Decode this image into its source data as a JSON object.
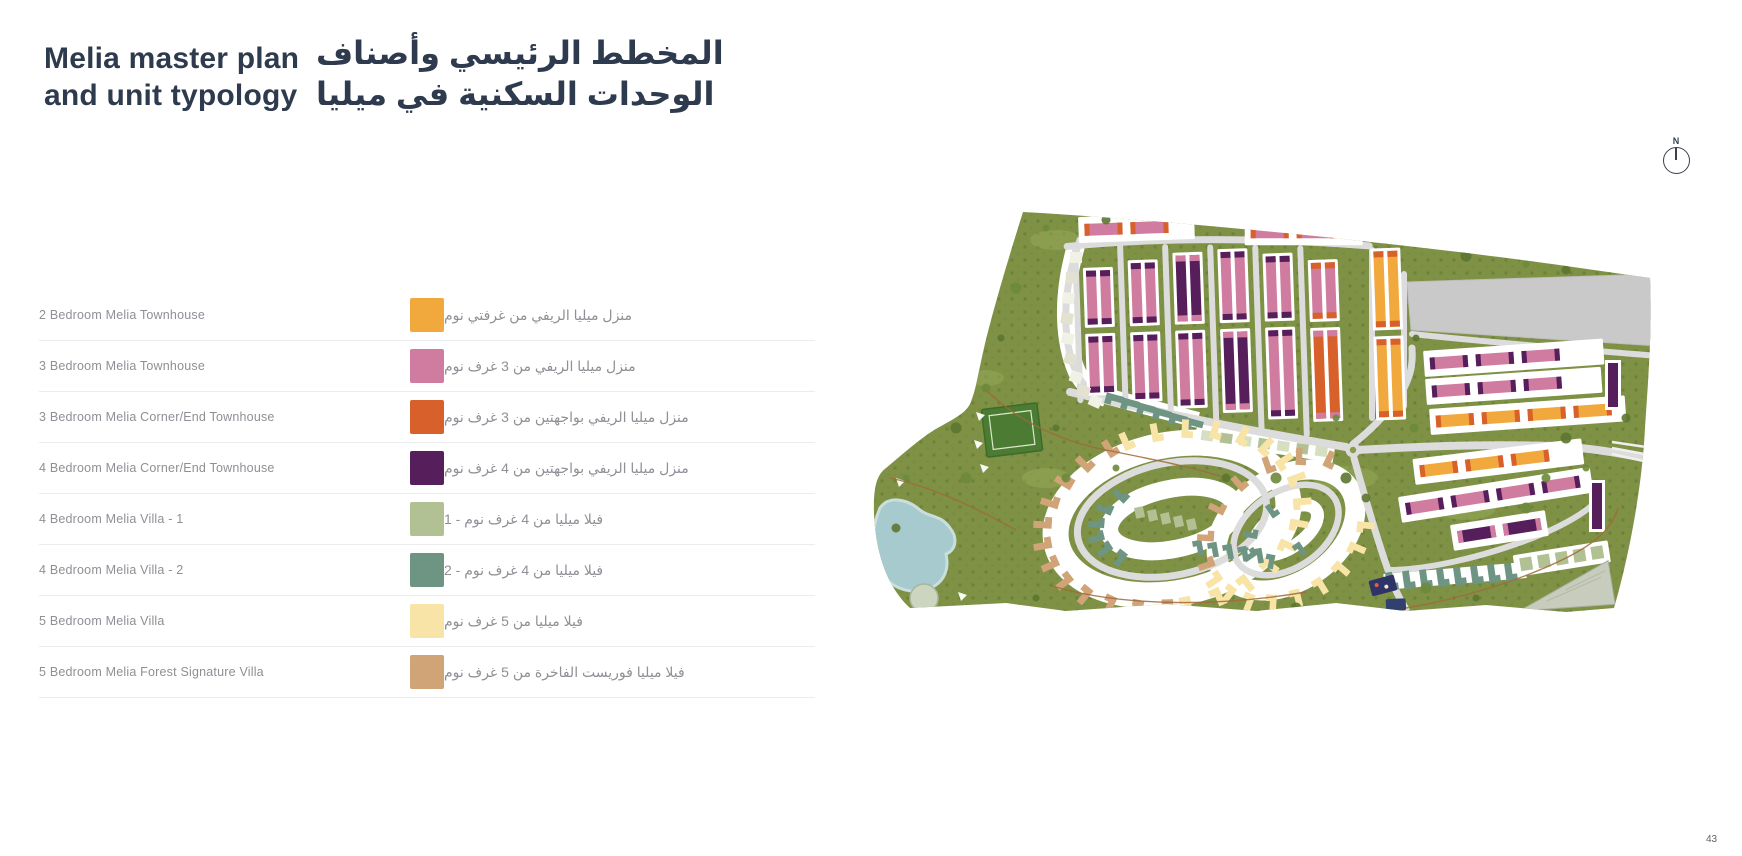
{
  "header": {
    "title_en": [
      "Melia master plan",
      "and unit typology"
    ],
    "title_ar": [
      "المخطط الرئيسي وأصناف",
      "الوحدات السكنية في ميليا"
    ]
  },
  "legend": {
    "rows": [
      {
        "en": "2 Bedroom Melia Townhouse",
        "ar": "منزل ميليا الريفي من غرفتي نوم",
        "color": "#F1A83C"
      },
      {
        "en": "3 Bedroom Melia Townhouse",
        "ar": "منزل ميليا الريفي من 3 غرف نوم",
        "color": "#D07CA0"
      },
      {
        "en": "3 Bedroom Melia Corner/End Townhouse",
        "ar": "منزل ميليا الريفي بواجهتين من 3 غرف نوم",
        "color": "#D8602A"
      },
      {
        "en": "4 Bedroom Melia Corner/End Townhouse",
        "ar": "منزل ميليا الريفي بواجهتين من 4 غرف نوم",
        "color": "#571E5C"
      },
      {
        "en": "4 Bedroom Melia Villa - 1",
        "ar": "فيلا ميليا من 4 غرف نوم - 1",
        "color": "#B2C194"
      },
      {
        "en": "4 Bedroom Melia Villa - 2",
        "ar": "فيلا ميليا من 4 غرف نوم - 2",
        "color": "#6E9584"
      },
      {
        "en": "5 Bedroom Melia Villa",
        "ar": "فيلا ميليا من 5 غرف نوم",
        "color": "#F7E4A6"
      },
      {
        "en": "5 Bedroom Melia Forest Signature Villa",
        "ar": "فيلا ميليا فوريست الفاخرة من 5 غرف نوم",
        "color": "#D1A478"
      }
    ]
  },
  "map": {
    "north_label": "N",
    "palette": {
      "ground": "#7E9144",
      "trees": "#5C7531",
      "road": "#DCDCDC",
      "parcel": "#C9C9C9",
      "water": "#A9CED5",
      "pitch": "#4C7C33"
    }
  },
  "footer": {
    "page_number": "43"
  }
}
